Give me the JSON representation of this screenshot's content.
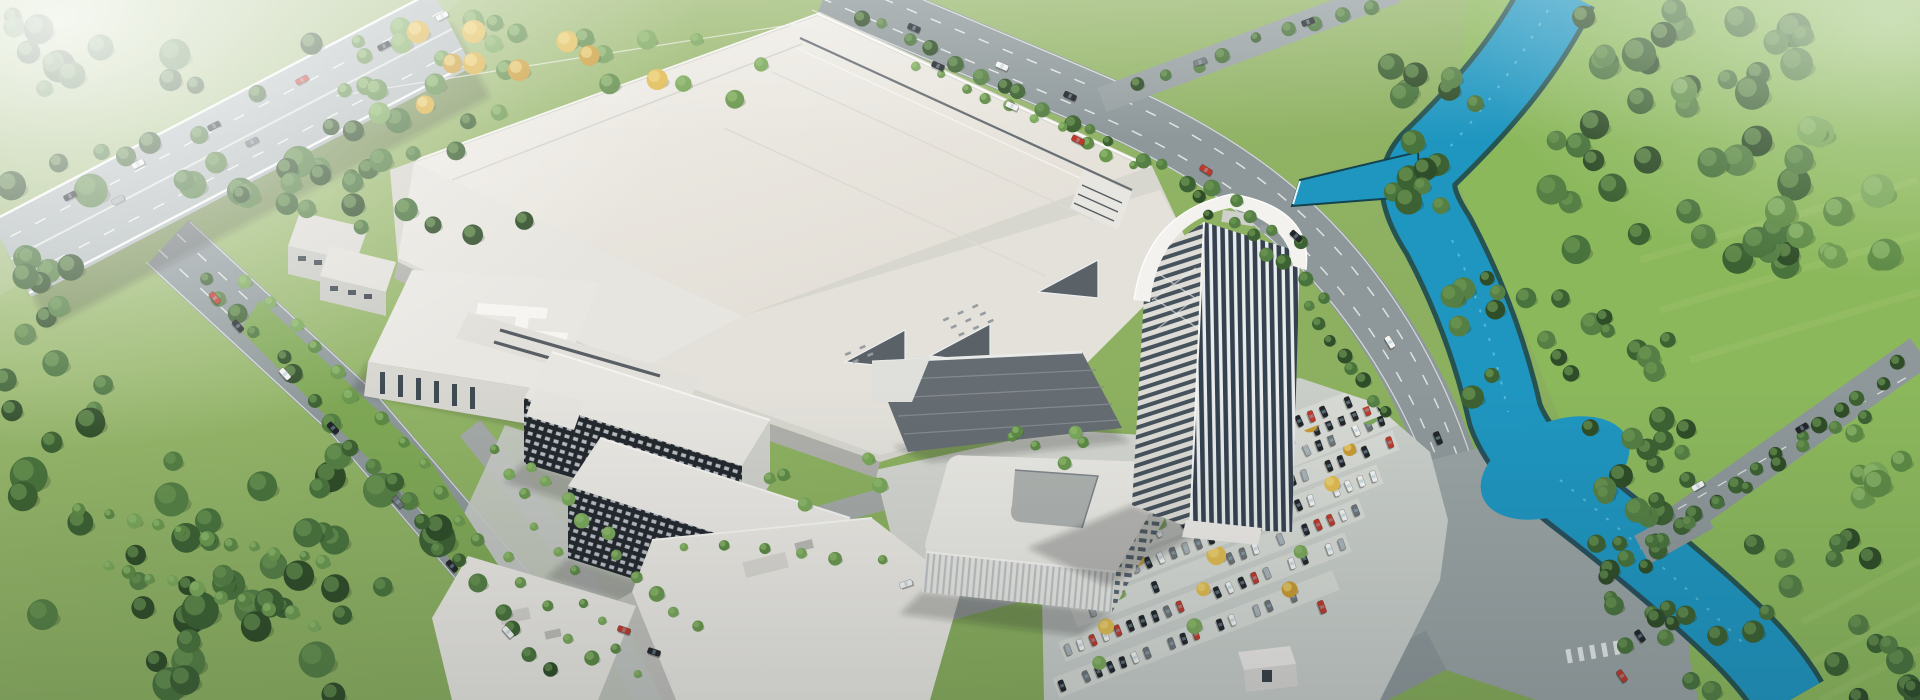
{
  "scene": {
    "kind": "aerial-architectural-rendering-industrial-campus",
    "landmarks": [
      "elevated-highway",
      "factory-hall",
      "office-tower",
      "admin-building",
      "dormitory-blocks",
      "canteen-hall",
      "parking-lot",
      "river",
      "ring-road",
      "forest",
      "meadow"
    ]
  },
  "palette": {
    "meadow_top": "#a6bf7c",
    "meadow_main": "#88af59",
    "meadow_right": "#8cb85c",
    "field_haze": "#a8c086",
    "forest_shadow": "#27361f",
    "river": "#1f96c0",
    "river_bank": "#14424f",
    "river_sparkle": "#7fd6e8",
    "highway": "#b2babb",
    "road": "#8e989a",
    "road_internal": "#a4a9a7",
    "intersection": "#9aa3a3",
    "lane_marking": "#f2f5f3",
    "parking_asphalt": "#c9cec9",
    "parking_row": "#d7dad4",
    "campus_plate": "#d7d6cf",
    "roof_bright": "#f0eee9",
    "roof_low": "#e4e0d8",
    "roof_tier": "#e3e1da",
    "facade_shade": "#b0b0ab",
    "atrium_roof": "#666d72",
    "dorm_glass": "#23282d",
    "tower_glass": "#35414e",
    "tower_white": "#f3f2ee",
    "autumn": "#dcb64e",
    "shadow": "rgba(30,38,34,0.24)"
  },
  "tree_palettes": {
    "forest": {
      "colors": [
        "#2f4d28",
        "#3c6132",
        "#49733c",
        "#557f44"
      ],
      "highlight": "#6f9a55"
    },
    "light": {
      "colors": [
        "#5d8a45",
        "#6b984f",
        "#7aa75a"
      ],
      "highlight": "#93bd6e"
    },
    "autumn": {
      "colors": [
        "#d9ae3f",
        "#e0bb52",
        "#c99a33"
      ],
      "highlight": "#efd579"
    }
  },
  "car_colors": {
    "dark": "#22262b",
    "white": "#f3f4f2",
    "grey": "#6e757a",
    "silver": "#aab1b5",
    "red": "#bf3a2b"
  },
  "vegetation": {
    "clusters": [
      {
        "x": 0,
        "y": 455,
        "w": 450,
        "h": 245,
        "n": 44,
        "rmin": 9,
        "rmax": 19,
        "pal": "forest",
        "seed": 11
      },
      {
        "x": 0,
        "y": 255,
        "w": 170,
        "h": 210,
        "n": 16,
        "rmin": 8,
        "rmax": 15,
        "pal": "forest",
        "seed": 12
      },
      {
        "x": 0,
        "y": 15,
        "w": 345,
        "h": 195,
        "n": 30,
        "rmin": 8,
        "rmax": 17,
        "pal": "forest",
        "seed": 13
      },
      {
        "x": 225,
        "y": 120,
        "w": 320,
        "h": 115,
        "n": 20,
        "rmin": 7,
        "rmax": 13,
        "pal": "forest",
        "seed": 14
      },
      {
        "x": 335,
        "y": 18,
        "w": 450,
        "h": 100,
        "n": 24,
        "rmin": 6,
        "rmax": 11,
        "pal": "light",
        "seed": 15
      },
      {
        "x": 365,
        "y": 30,
        "w": 320,
        "h": 80,
        "n": 9,
        "rmin": 7,
        "rmax": 12,
        "pal": "autumn",
        "seed": 16
      },
      {
        "x": 1385,
        "y": 55,
        "w": 95,
        "h": 180,
        "n": 16,
        "rmin": 8,
        "rmax": 14,
        "pal": "forest",
        "seed": 17
      },
      {
        "x": 1540,
        "y": 0,
        "w": 270,
        "h": 265,
        "n": 42,
        "rmin": 9,
        "rmax": 18,
        "pal": "forest",
        "seed": 18
      },
      {
        "x": 1452,
        "y": 248,
        "w": 75,
        "h": 155,
        "n": 10,
        "rmin": 7,
        "rmax": 12,
        "pal": "forest",
        "seed": 19
      },
      {
        "x": 1532,
        "y": 298,
        "w": 140,
        "h": 135,
        "n": 13,
        "rmin": 7,
        "rmax": 13,
        "pal": "forest",
        "seed": 20
      },
      {
        "x": 1590,
        "y": 415,
        "w": 150,
        "h": 110,
        "n": 14,
        "rmin": 7,
        "rmax": 13,
        "pal": "forest",
        "seed": 21
      },
      {
        "x": 1596,
        "y": 538,
        "w": 80,
        "h": 120,
        "n": 10,
        "rmin": 6,
        "rmax": 11,
        "pal": "forest",
        "seed": 22
      },
      {
        "x": 1742,
        "y": 538,
        "w": 130,
        "h": 95,
        "n": 10,
        "rmin": 7,
        "rmax": 12,
        "pal": "forest",
        "seed": 23
      },
      {
        "x": 1828,
        "y": 636,
        "w": 92,
        "h": 64,
        "n": 8,
        "rmin": 8,
        "rmax": 14,
        "pal": "forest",
        "seed": 24
      },
      {
        "x": 1648,
        "y": 598,
        "w": 72,
        "h": 100,
        "n": 9,
        "rmin": 6,
        "rmax": 11,
        "pal": "forest",
        "seed": 25
      },
      {
        "x": 1672,
        "y": 75,
        "w": 250,
        "h": 215,
        "n": 11,
        "rmin": 10,
        "rmax": 17,
        "pal": "light",
        "seed": 26
      },
      {
        "x": 1810,
        "y": 430,
        "w": 110,
        "h": 130,
        "n": 6,
        "rmin": 9,
        "rmax": 15,
        "pal": "light",
        "seed": 27
      },
      {
        "x": 745,
        "y": 455,
        "w": 140,
        "h": 70,
        "n": 6,
        "rmin": 5,
        "rmax": 8,
        "pal": "light",
        "seed": 28
      },
      {
        "x": 985,
        "y": 430,
        "w": 130,
        "h": 45,
        "n": 6,
        "rmin": 4,
        "rmax": 7,
        "pal": "light",
        "seed": 29
      }
    ],
    "lines": [
      {
        "x1": 848,
        "y1": 8,
        "x2": 1312,
        "y2": 242,
        "n": 20,
        "rmin": 5,
        "rmax": 9,
        "jit": 7,
        "pal": "forest",
        "seed": 31
      },
      {
        "x1": 905,
        "y1": 58,
        "x2": 1142,
        "y2": 168,
        "n": 10,
        "rmin": 4,
        "rmax": 7,
        "jit": 5,
        "pal": "light",
        "seed": 32
      },
      {
        "x1": 1122,
        "y1": 86,
        "x2": 1388,
        "y2": -2,
        "n": 9,
        "rmin": 5,
        "rmax": 8,
        "jit": 6,
        "pal": "forest",
        "seed": 33
      },
      {
        "x1": 196,
        "y1": 264,
        "x2": 562,
        "y2": 682,
        "n": 20,
        "rmin": 6,
        "rmax": 10,
        "jit": 7,
        "pal": "forest",
        "seed": 34
      },
      {
        "x1": 240,
        "y1": 270,
        "x2": 598,
        "y2": 668,
        "n": 17,
        "rmin": 5,
        "rmax": 8,
        "jit": 6,
        "pal": "light",
        "seed": 35
      },
      {
        "x1": 482,
        "y1": 432,
        "x2": 642,
        "y2": 690,
        "n": 10,
        "rmin": 4,
        "rmax": 7,
        "jit": 5,
        "pal": "light",
        "seed": 36
      },
      {
        "x1": 522,
        "y1": 452,
        "x2": 702,
        "y2": 640,
        "n": 10,
        "rmin": 5,
        "rmax": 8,
        "jit": 6,
        "pal": "light",
        "seed": 37
      },
      {
        "x1": 662,
        "y1": 542,
        "x2": 898,
        "y2": 562,
        "n": 6,
        "rmin": 4,
        "rmax": 7,
        "jit": 5,
        "pal": "light",
        "seed": 38
      },
      {
        "x1": 70,
        "y1": 505,
        "x2": 338,
        "y2": 566,
        "n": 11,
        "rmin": 5,
        "rmax": 8,
        "jit": 4,
        "pal": "light",
        "seed": 39
      },
      {
        "x1": 96,
        "y1": 560,
        "x2": 322,
        "y2": 626,
        "n": 10,
        "rmin": 5,
        "rmax": 8,
        "jit": 4,
        "pal": "light",
        "seed": 40
      },
      {
        "x1": 1648,
        "y1": 548,
        "x2": 1910,
        "y2": 360,
        "n": 13,
        "rmin": 6,
        "rmax": 9,
        "jit": 5,
        "pal": "forest",
        "seed": 41
      },
      {
        "x1": 1610,
        "y1": 568,
        "x2": 1880,
        "y2": 405,
        "n": 9,
        "rmin": 6,
        "rmax": 9,
        "jit": 5,
        "pal": "forest",
        "seed": 42
      },
      {
        "x1": 1185,
        "y1": 192,
        "x2": 1332,
        "y2": 300,
        "n": 8,
        "rmin": 5,
        "rmax": 8,
        "jit": 5,
        "pal": "forest",
        "seed": 43
      },
      {
        "x1": 1300,
        "y1": 302,
        "x2": 1392,
        "y2": 418,
        "n": 8,
        "rmin": 5,
        "rmax": 8,
        "jit": 5,
        "pal": "forest",
        "seed": 44
      }
    ]
  },
  "parking": {
    "rows": [
      {
        "x1": 1056,
        "y1": 688,
        "x2": 1336,
        "y2": 580
      },
      {
        "x1": 1062,
        "y1": 652,
        "x2": 1348,
        "y2": 542
      },
      {
        "x1": 1074,
        "y1": 618,
        "x2": 1362,
        "y2": 508
      },
      {
        "x1": 1092,
        "y1": 584,
        "x2": 1380,
        "y2": 474
      },
      {
        "x1": 1116,
        "y1": 548,
        "x2": 1396,
        "y2": 440
      },
      {
        "x1": 1152,
        "y1": 512,
        "x2": 1412,
        "y2": 408
      },
      {
        "x1": 1196,
        "y1": 476,
        "x2": 1424,
        "y2": 388
      },
      {
        "x1": 1244,
        "y1": 442,
        "x2": 1428,
        "y2": 372
      }
    ],
    "slot_pitch": 13,
    "occupancy": 0.68
  },
  "traffic": {
    "cars": [
      [
        70,
        196,
        -27,
        "dark"
      ],
      [
        138,
        164,
        -27,
        "white"
      ],
      [
        214,
        126,
        -27,
        "dark"
      ],
      [
        302,
        80,
        -27,
        "red"
      ],
      [
        384,
        46,
        -27,
        "dark"
      ],
      [
        442,
        16,
        -27,
        "white"
      ],
      [
        252,
        142,
        -27,
        "grey"
      ],
      [
        118,
        200,
        -27,
        "silver"
      ],
      [
        215,
        298,
        48,
        "red"
      ],
      [
        238,
        326,
        48,
        "dark"
      ],
      [
        285,
        374,
        48,
        "white"
      ],
      [
        333,
        428,
        48,
        "dark"
      ],
      [
        398,
        502,
        48,
        "grey"
      ],
      [
        452,
        566,
        48,
        "dark"
      ],
      [
        508,
        632,
        48,
        "white"
      ],
      [
        914,
        28,
        23,
        "dark"
      ],
      [
        1002,
        66,
        23,
        "white"
      ],
      [
        1070,
        96,
        25,
        "dark"
      ],
      [
        1206,
        170,
        32,
        "red"
      ],
      [
        1296,
        236,
        42,
        "dark"
      ],
      [
        1390,
        342,
        58,
        "white"
      ],
      [
        1438,
        438,
        68,
        "dark"
      ],
      [
        1200,
        62,
        -20,
        "grey"
      ],
      [
        1308,
        22,
        -20,
        "dark"
      ],
      [
        1698,
        486,
        -30,
        "white"
      ],
      [
        1802,
        428,
        -30,
        "dark"
      ],
      [
        1640,
        636,
        55,
        "dark"
      ],
      [
        1622,
        676,
        55,
        "red"
      ],
      [
        624,
        630,
        18,
        "red"
      ],
      [
        654,
        652,
        18,
        "dark"
      ],
      [
        906,
        584,
        -18,
        "white"
      ],
      [
        1322,
        607,
        70,
        "red"
      ],
      [
        938,
        66,
        24,
        "dark"
      ],
      [
        1012,
        106,
        24,
        "white"
      ],
      [
        1078,
        140,
        26,
        "red"
      ]
    ]
  }
}
